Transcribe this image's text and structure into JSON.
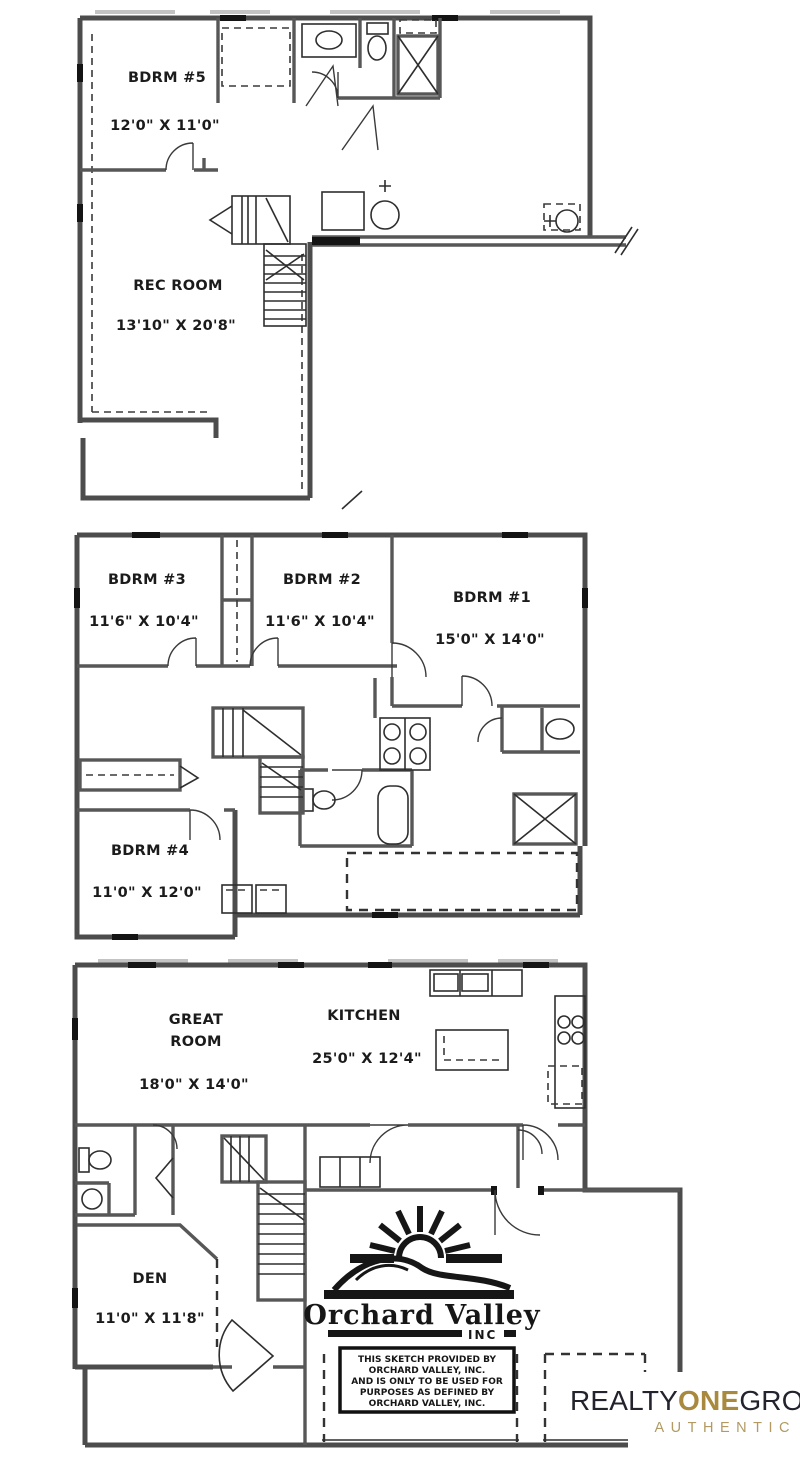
{
  "rooms": {
    "bdrm5": {
      "label": "BDRM #5",
      "dims": "12'0\" X 11'0\""
    },
    "rec_room": {
      "label": "REC ROOM",
      "dims": "13'10\" X 20'8\""
    },
    "bdrm3": {
      "label": "BDRM #3",
      "dims": "11'6\" X 10'4\""
    },
    "bdrm2": {
      "label": "BDRM #2",
      "dims": "11'6\" X 10'4\""
    },
    "bdrm1": {
      "label": "BDRM #1",
      "dims": "15'0\" X 14'0\""
    },
    "bdrm4": {
      "label": "BDRM #4",
      "dims": "11'0\" X 12'0\""
    },
    "great_room": {
      "label_line1": "GREAT",
      "label_line2": "ROOM",
      "dims": "18'0\" X 14'0\""
    },
    "kitchen": {
      "label": "KITCHEN",
      "dims": "25'0\" X 12'4\""
    },
    "den": {
      "label": "DEN",
      "dims": "11'0\" X 11'8\""
    }
  },
  "builder": {
    "name": "Orchard Valley",
    "suffix": "INC",
    "disclaimer_lines": [
      "THIS SKETCH PROVIDED BY",
      "ORCHARD VALLEY, INC.",
      "AND IS ONLY TO BE USED FOR",
      "PURPOSES AS DEFINED BY",
      "ORCHARD VALLEY, INC."
    ]
  },
  "brokerage": {
    "word1": "REALTY",
    "word2": "ONE",
    "word3": "GROUP",
    "subtitle": "AUTHENTIC",
    "colors": {
      "dark": "#23232d",
      "gold": "#a8893d",
      "subtitle_gold": "#b29a62"
    }
  }
}
